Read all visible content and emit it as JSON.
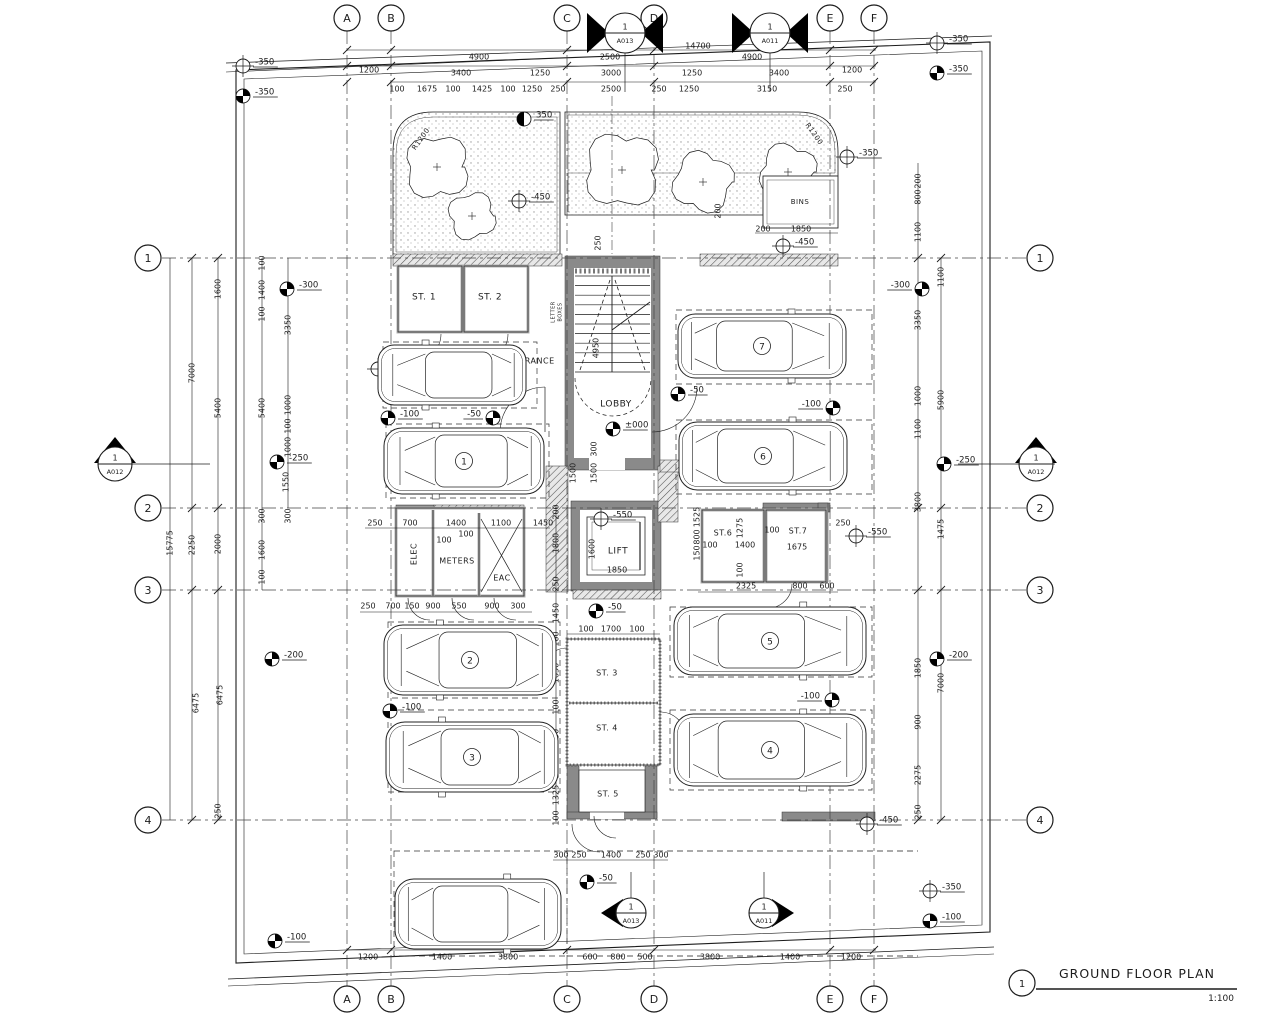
{
  "title": {
    "detail_no": "1",
    "label": "GROUND FLOOR PLAN",
    "scale": "1:100"
  },
  "colors": {
    "line": "#1c1c1c",
    "wall": "#8a8a8a",
    "wall_dark": "#6f6f6f",
    "hatch": "#555555",
    "stipple": "#9a9a9a",
    "accent": "#000000"
  },
  "grid": {
    "cols": [
      {
        "label": "A",
        "x": 347
      },
      {
        "label": "B",
        "x": 391
      },
      {
        "label": "C",
        "x": 567
      },
      {
        "label": "D",
        "x": 654
      },
      {
        "label": "E",
        "x": 830
      },
      {
        "label": "F",
        "x": 874
      }
    ],
    "rows": [
      {
        "label": "1",
        "y": 258
      },
      {
        "label": "2",
        "y": 508
      },
      {
        "label": "3",
        "y": 590
      },
      {
        "label": "4",
        "y": 820
      }
    ]
  },
  "sections": [
    {
      "no": "1",
      "sheet": "A013",
      "x": 625,
      "y": 33,
      "r": 20,
      "tri": "flank"
    },
    {
      "no": "1",
      "sheet": "A011",
      "x": 770,
      "y": 33,
      "r": 20,
      "tri": "flank"
    },
    {
      "no": "1",
      "sheet": "A012",
      "x": 115,
      "y": 464,
      "r": 17,
      "tri": "up"
    },
    {
      "no": "1",
      "sheet": "A012",
      "x": 1036,
      "y": 464,
      "r": 17,
      "tri": "up"
    },
    {
      "no": "1",
      "sheet": "A013",
      "x": 631,
      "y": 913,
      "r": 15,
      "tri": "left"
    },
    {
      "no": "1",
      "sheet": "A011",
      "x": 764,
      "y": 913,
      "r": 15,
      "tri": "right"
    }
  ],
  "labels": [
    {
      "t": "ST. 1",
      "x": 424,
      "y": 297,
      "fs": 9
    },
    {
      "t": "ST. 2",
      "x": 490,
      "y": 297,
      "fs": 9
    },
    {
      "t": "ENTRANCE",
      "x": 531,
      "y": 361,
      "fs": 8
    },
    {
      "t": "LOBBY",
      "x": 616,
      "y": 404,
      "fs": 9
    },
    {
      "t": "LIFT",
      "x": 618,
      "y": 551,
      "fs": 9
    },
    {
      "t": "ELEC",
      "x": 414,
      "y": 554,
      "fs": 8,
      "r": -90
    },
    {
      "t": "METERS",
      "x": 457,
      "y": 561,
      "fs": 8
    },
    {
      "t": "EAC",
      "x": 502,
      "y": 578,
      "fs": 8
    },
    {
      "t": "ST.6",
      "x": 723,
      "y": 533,
      "fs": 8
    },
    {
      "t": "ST.7",
      "x": 798,
      "y": 531,
      "fs": 8
    },
    {
      "t": "ST. 3",
      "x": 607,
      "y": 673,
      "fs": 8
    },
    {
      "t": "ST. 4",
      "x": 607,
      "y": 728,
      "fs": 8
    },
    {
      "t": "ST. 5",
      "x": 608,
      "y": 794,
      "fs": 8
    },
    {
      "t": "BINS",
      "x": 800,
      "y": 202,
      "fs": 7
    },
    {
      "t": "AMEA",
      "x": 470,
      "y": 913,
      "fs": 9
    },
    {
      "t": "Optional",
      "x": 441,
      "y": 374,
      "fs": 9
    },
    {
      "t": "LETTER",
      "x": 553,
      "y": 312,
      "fs": 5,
      "r": -90
    },
    {
      "t": "BOXES",
      "x": 560,
      "y": 312,
      "fs": 5,
      "r": -90
    },
    {
      "t": "R1200",
      "x": 421,
      "y": 139,
      "fs": 7,
      "r": -55
    },
    {
      "t": "R1200",
      "x": 814,
      "y": 134,
      "fs": 7,
      "r": 55
    }
  ],
  "cars": [
    {
      "id": "optional",
      "x": 452,
      "y": 375,
      "w": 148,
      "h": 60,
      "dir": -1,
      "n": ""
    },
    {
      "id": "1",
      "x": 464,
      "y": 461,
      "w": 160,
      "h": 66,
      "dir": -1,
      "n": "1"
    },
    {
      "id": "2",
      "x": 470,
      "y": 660,
      "w": 172,
      "h": 70,
      "dir": -1,
      "n": "2"
    },
    {
      "id": "3",
      "x": 472,
      "y": 757,
      "w": 172,
      "h": 70,
      "dir": -1,
      "n": "3"
    },
    {
      "id": "4",
      "x": 770,
      "y": 750,
      "w": 192,
      "h": 72,
      "dir": 1,
      "n": "4"
    },
    {
      "id": "5",
      "x": 770,
      "y": 641,
      "w": 192,
      "h": 68,
      "dir": 1,
      "n": "5"
    },
    {
      "id": "6",
      "x": 763,
      "y": 456,
      "w": 168,
      "h": 68,
      "dir": 1,
      "n": "6"
    },
    {
      "id": "7",
      "x": 762,
      "y": 346,
      "w": 168,
      "h": 64,
      "dir": 1,
      "n": "7"
    },
    {
      "id": "amea",
      "x": 478,
      "y": 914,
      "w": 166,
      "h": 70,
      "dir": 1,
      "n": ""
    }
  ],
  "levels": [
    {
      "t": "-350",
      "x": 243,
      "y": 66,
      "s": "open"
    },
    {
      "t": "-350",
      "x": 243,
      "y": 96,
      "s": "filled"
    },
    {
      "t": "-350",
      "x": 937,
      "y": 43,
      "s": "open"
    },
    {
      "t": "-350",
      "x": 937,
      "y": 73,
      "s": "filled"
    },
    {
      "t": "350",
      "x": 524,
      "y": 119,
      "s": "half"
    },
    {
      "t": "-450",
      "x": 519,
      "y": 201,
      "s": "open"
    },
    {
      "t": "-350",
      "x": 847,
      "y": 157,
      "s": "open"
    },
    {
      "t": "-450",
      "x": 783,
      "y": 246,
      "s": "open"
    },
    {
      "t": "-300",
      "x": 287,
      "y": 289,
      "s": "filled"
    },
    {
      "t": "-300",
      "x": 922,
      "y": 289,
      "s": "filled",
      "d": "l"
    },
    {
      "t": "-550",
      "x": 378,
      "y": 369,
      "s": "open"
    },
    {
      "t": "-100",
      "x": 388,
      "y": 418,
      "s": "filled"
    },
    {
      "t": "-50",
      "x": 493,
      "y": 418,
      "s": "filled",
      "d": "l"
    },
    {
      "t": "±000",
      "x": 613,
      "y": 429,
      "s": "filled"
    },
    {
      "t": "-50",
      "x": 678,
      "y": 394,
      "s": "filled"
    },
    {
      "t": "-550",
      "x": 700,
      "y": 347,
      "s": "open"
    },
    {
      "t": "-100",
      "x": 833,
      "y": 408,
      "s": "filled",
      "d": "l"
    },
    {
      "t": "-250",
      "x": 277,
      "y": 462,
      "s": "filled"
    },
    {
      "t": "-250",
      "x": 944,
      "y": 464,
      "s": "filled"
    },
    {
      "t": "-550",
      "x": 601,
      "y": 519,
      "s": "open"
    },
    {
      "t": "-550",
      "x": 856,
      "y": 536,
      "s": "open"
    },
    {
      "t": "-50",
      "x": 596,
      "y": 611,
      "s": "filled"
    },
    {
      "t": "-550",
      "x": 474,
      "y": 656,
      "s": "open"
    },
    {
      "t": "-100",
      "x": 390,
      "y": 711,
      "s": "filled"
    },
    {
      "t": "-200",
      "x": 272,
      "y": 659,
      "s": "filled"
    },
    {
      "t": "-200",
      "x": 937,
      "y": 659,
      "s": "filled"
    },
    {
      "t": "-100",
      "x": 832,
      "y": 700,
      "s": "filled",
      "d": "l"
    },
    {
      "t": "-450",
      "x": 867,
      "y": 824,
      "s": "open"
    },
    {
      "t": "-50",
      "x": 587,
      "y": 882,
      "s": "filled"
    },
    {
      "t": "-100",
      "x": 275,
      "y": 941,
      "s": "filled"
    },
    {
      "t": "-350",
      "x": 930,
      "y": 891,
      "s": "open"
    },
    {
      "t": "-100",
      "x": 930,
      "y": 921,
      "s": "filled"
    }
  ],
  "dims": [
    {
      "t": "14700",
      "x": 698,
      "y": 46
    },
    {
      "t": "4900",
      "x": 479,
      "y": 57
    },
    {
      "t": "2500",
      "x": 610,
      "y": 57
    },
    {
      "t": "4900",
      "x": 752,
      "y": 57
    },
    {
      "t": "1200",
      "x": 369,
      "y": 70
    },
    {
      "t": "1200",
      "x": 852,
      "y": 70
    },
    {
      "t": "3400",
      "x": 461,
      "y": 73
    },
    {
      "t": "1250",
      "x": 540,
      "y": 73
    },
    {
      "t": "3000",
      "x": 611,
      "y": 73
    },
    {
      "t": "1250",
      "x": 692,
      "y": 73
    },
    {
      "t": "3400",
      "x": 779,
      "y": 73
    },
    {
      "t": "100",
      "x": 397,
      "y": 89
    },
    {
      "t": "1675",
      "x": 427,
      "y": 89
    },
    {
      "t": "100",
      "x": 453,
      "y": 89
    },
    {
      "t": "1425",
      "x": 482,
      "y": 89
    },
    {
      "t": "100",
      "x": 508,
      "y": 89
    },
    {
      "t": "1250",
      "x": 532,
      "y": 89
    },
    {
      "t": "250",
      "x": 558,
      "y": 89
    },
    {
      "t": "2500",
      "x": 611,
      "y": 89
    },
    {
      "t": "250",
      "x": 659,
      "y": 89
    },
    {
      "t": "1250",
      "x": 689,
      "y": 89
    },
    {
      "t": "3150",
      "x": 767,
      "y": 89
    },
    {
      "t": "250",
      "x": 845,
      "y": 89
    },
    {
      "t": "200",
      "x": 763,
      "y": 229
    },
    {
      "t": "1850",
      "x": 801,
      "y": 229
    },
    {
      "t": "200",
      "x": 718,
      "y": 211,
      "r": -90
    },
    {
      "t": "250",
      "x": 598,
      "y": 243,
      "r": -90
    },
    {
      "t": "15775",
      "x": 170,
      "y": 543,
      "r": -90
    },
    {
      "t": "7000",
      "x": 192,
      "y": 373,
      "r": -90
    },
    {
      "t": "2250",
      "x": 192,
      "y": 545,
      "r": -90
    },
    {
      "t": "6475",
      "x": 196,
      "y": 703,
      "r": -90
    },
    {
      "t": "1600",
      "x": 218,
      "y": 289,
      "r": -90
    },
    {
      "t": "5400",
      "x": 218,
      "y": 408,
      "r": -90
    },
    {
      "t": "2000",
      "x": 218,
      "y": 544,
      "r": -90
    },
    {
      "t": "6475",
      "x": 220,
      "y": 695,
      "r": -90
    },
    {
      "t": "250",
      "x": 218,
      "y": 811,
      "r": -90
    },
    {
      "t": "100",
      "x": 262,
      "y": 263,
      "r": -90
    },
    {
      "t": "1400",
      "x": 262,
      "y": 290,
      "r": -90
    },
    {
      "t": "100",
      "x": 262,
      "y": 314,
      "r": -90
    },
    {
      "t": "5400",
      "x": 262,
      "y": 408,
      "r": -90
    },
    {
      "t": "300",
      "x": 262,
      "y": 516,
      "r": -90
    },
    {
      "t": "1600",
      "x": 262,
      "y": 550,
      "r": -90
    },
    {
      "t": "100",
      "x": 262,
      "y": 577,
      "r": -90
    },
    {
      "t": "3350",
      "x": 288,
      "y": 325,
      "r": -90
    },
    {
      "t": "1000",
      "x": 288,
      "y": 405,
      "r": -90
    },
    {
      "t": "100",
      "x": 288,
      "y": 426,
      "r": -90
    },
    {
      "t": "1000",
      "x": 288,
      "y": 447,
      "r": -90
    },
    {
      "t": "1550",
      "x": 286,
      "y": 482,
      "r": -90
    },
    {
      "t": "300",
      "x": 288,
      "y": 516,
      "r": -90
    },
    {
      "t": "200",
      "x": 918,
      "y": 181,
      "r": -90
    },
    {
      "t": "800",
      "x": 918,
      "y": 197,
      "r": -90
    },
    {
      "t": "1100",
      "x": 918,
      "y": 232,
      "r": -90
    },
    {
      "t": "3350",
      "x": 918,
      "y": 320,
      "r": -90
    },
    {
      "t": "1000",
      "x": 918,
      "y": 396,
      "r": -90
    },
    {
      "t": "1100",
      "x": 918,
      "y": 429,
      "r": -90
    },
    {
      "t": "3800",
      "x": 918,
      "y": 502,
      "r": -90
    },
    {
      "t": "1850",
      "x": 918,
      "y": 668,
      "r": -90
    },
    {
      "t": "900",
      "x": 918,
      "y": 722,
      "r": -90
    },
    {
      "t": "2275",
      "x": 918,
      "y": 775,
      "r": -90
    },
    {
      "t": "250",
      "x": 918,
      "y": 812,
      "r": -90
    },
    {
      "t": "1100",
      "x": 941,
      "y": 277,
      "r": -90
    },
    {
      "t": "5900",
      "x": 941,
      "y": 400,
      "r": -90
    },
    {
      "t": "1475",
      "x": 941,
      "y": 529,
      "r": -90
    },
    {
      "t": "7000",
      "x": 941,
      "y": 683,
      "r": -90
    },
    {
      "t": "250",
      "x": 375,
      "y": 523
    },
    {
      "t": "700",
      "x": 410,
      "y": 523
    },
    {
      "t": "1400",
      "x": 456,
      "y": 523
    },
    {
      "t": "1100",
      "x": 501,
      "y": 523
    },
    {
      "t": "1450",
      "x": 543,
      "y": 523
    },
    {
      "t": "100",
      "x": 444,
      "y": 540
    },
    {
      "t": "100",
      "x": 466,
      "y": 534
    },
    {
      "t": "250",
      "x": 368,
      "y": 606
    },
    {
      "t": "700",
      "x": 393,
      "y": 606
    },
    {
      "t": "150",
      "x": 412,
      "y": 606
    },
    {
      "t": "900",
      "x": 433,
      "y": 606
    },
    {
      "t": "550",
      "x": 459,
      "y": 606
    },
    {
      "t": "900",
      "x": 492,
      "y": 606
    },
    {
      "t": "300",
      "x": 518,
      "y": 606
    },
    {
      "t": "200",
      "x": 556,
      "y": 512,
      "r": -90
    },
    {
      "t": "1800",
      "x": 556,
      "y": 543,
      "r": -90
    },
    {
      "t": "250",
      "x": 556,
      "y": 584,
      "r": -90
    },
    {
      "t": "1450",
      "x": 556,
      "y": 613,
      "r": -90
    },
    {
      "t": "100",
      "x": 556,
      "y": 639,
      "r": -90
    },
    {
      "t": "1650",
      "x": 556,
      "y": 673,
      "r": -90
    },
    {
      "t": "100",
      "x": 556,
      "y": 707,
      "r": -90
    },
    {
      "t": "1650",
      "x": 556,
      "y": 739,
      "r": -90
    },
    {
      "t": "100",
      "x": 556,
      "y": 771,
      "r": -90
    },
    {
      "t": "1325",
      "x": 556,
      "y": 795,
      "r": -90
    },
    {
      "t": "100",
      "x": 556,
      "y": 818,
      "r": -90
    },
    {
      "t": "100",
      "x": 586,
      "y": 629
    },
    {
      "t": "1700",
      "x": 611,
      "y": 629
    },
    {
      "t": "100",
      "x": 637,
      "y": 629
    },
    {
      "t": "1850",
      "x": 617,
      "y": 570
    },
    {
      "t": "1600",
      "x": 592,
      "y": 549,
      "r": -90
    },
    {
      "t": "4950",
      "x": 596,
      "y": 348,
      "r": -90
    },
    {
      "t": "300",
      "x": 594,
      "y": 449,
      "r": -90
    },
    {
      "t": "1500",
      "x": 573,
      "y": 473,
      "r": -90
    },
    {
      "t": "1500",
      "x": 594,
      "y": 473,
      "r": -90
    },
    {
      "t": "-20",
      "x": 509,
      "y": 389
    },
    {
      "t": "1525",
      "x": 697,
      "y": 517,
      "r": -90
    },
    {
      "t": "800",
      "x": 697,
      "y": 537,
      "r": -90
    },
    {
      "t": "150",
      "x": 697,
      "y": 553,
      "r": -90
    },
    {
      "t": "100",
      "x": 710,
      "y": 545
    },
    {
      "t": "1400",
      "x": 745,
      "y": 545
    },
    {
      "t": "1275",
      "x": 740,
      "y": 528,
      "r": -90
    },
    {
      "t": "100",
      "x": 740,
      "y": 570,
      "r": -90
    },
    {
      "t": "100",
      "x": 772,
      "y": 530
    },
    {
      "t": "1675",
      "x": 797,
      "y": 547
    },
    {
      "t": "250",
      "x": 843,
      "y": 523
    },
    {
      "t": "2325",
      "x": 746,
      "y": 586
    },
    {
      "t": "800",
      "x": 800,
      "y": 586
    },
    {
      "t": "600",
      "x": 827,
      "y": 586
    },
    {
      "t": "300",
      "x": 561,
      "y": 855
    },
    {
      "t": "250",
      "x": 579,
      "y": 855
    },
    {
      "t": "1400",
      "x": 611,
      "y": 855
    },
    {
      "t": "250",
      "x": 643,
      "y": 855
    },
    {
      "t": "300",
      "x": 661,
      "y": 855
    },
    {
      "t": "1200",
      "x": 368,
      "y": 957
    },
    {
      "t": "1400",
      "x": 442,
      "y": 957
    },
    {
      "t": "3800",
      "x": 508,
      "y": 957
    },
    {
      "t": "600",
      "x": 590,
      "y": 957
    },
    {
      "t": "800",
      "x": 618,
      "y": 957
    },
    {
      "t": "500",
      "x": 645,
      "y": 957
    },
    {
      "t": "3800",
      "x": 710,
      "y": 957
    },
    {
      "t": "1400",
      "x": 790,
      "y": 957
    },
    {
      "t": "1200",
      "x": 851,
      "y": 957
    }
  ]
}
